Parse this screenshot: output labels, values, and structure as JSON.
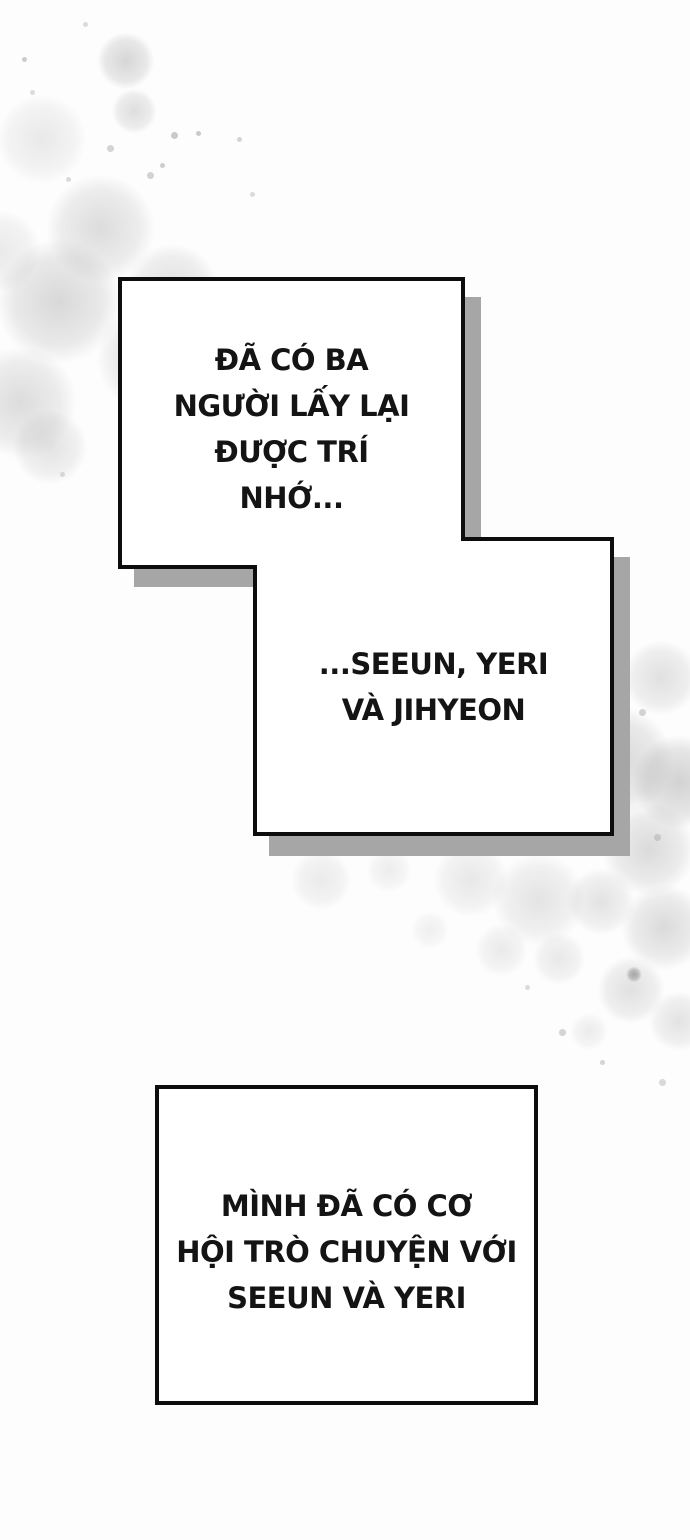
{
  "page": {
    "background_color": "#fdfdfd"
  },
  "colors": {
    "panel_border": "#0d0d0d",
    "panel_fill": "#ffffff",
    "panel_shadow": "#a6a6a6",
    "text_ink": "#141414",
    "watercolor_gray": "#a0a0a0"
  },
  "panels": [
    {
      "name": "narration-box-1",
      "lines": [
        "ĐÃ CÓ BA",
        "NGƯỜI LẤY LẠI",
        "ĐƯỢC TRÍ",
        "NHỚ..."
      ]
    },
    {
      "name": "narration-box-2",
      "lines": [
        "...SEEUN, YERI",
        "VÀ JIHYEON"
      ]
    },
    {
      "name": "narration-box-3",
      "lines": [
        "MÌNH ĐÃ CÓ CƠ",
        "HỘI TRÒ CHUYỆN VỚI",
        "SEEUN VÀ YERI"
      ]
    }
  ]
}
